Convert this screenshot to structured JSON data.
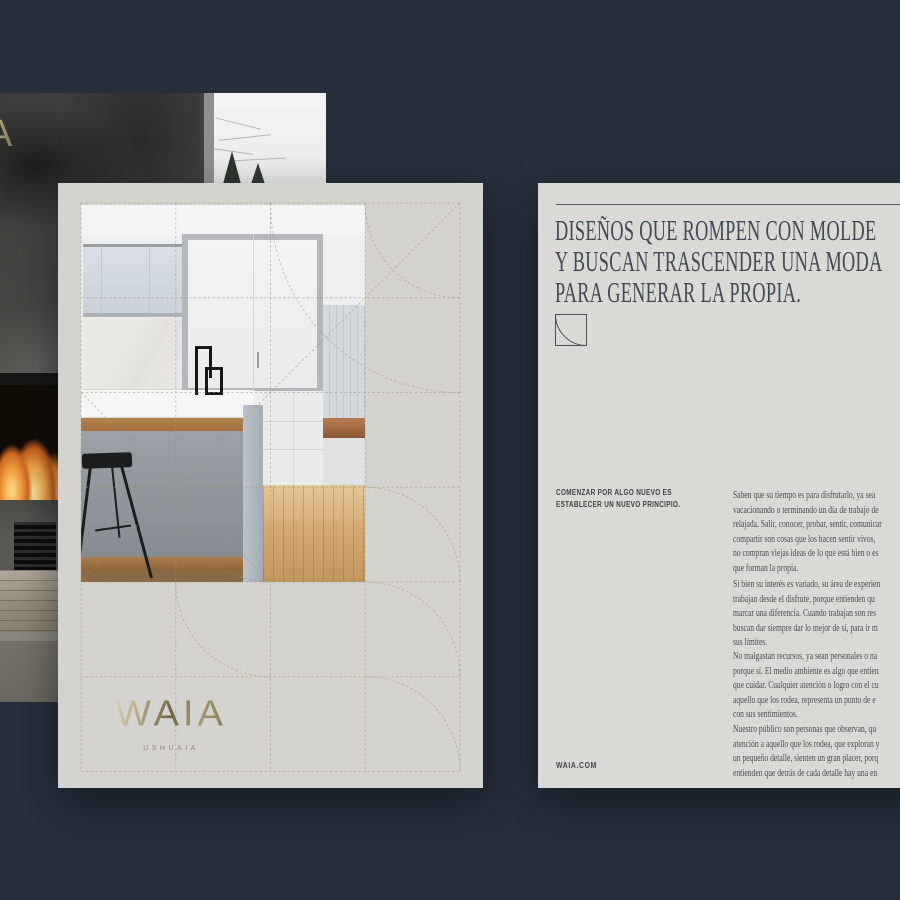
{
  "left_poster": {
    "logo": "WAIA",
    "location": "USHUAIA"
  },
  "right_page": {
    "headline_lines": [
      "DISEÑOS QUE ROMPEN CON MOLDE",
      "Y BUSCAN TRASCENDER UNA MODA",
      "PARA GENERAR LA PROPIA."
    ],
    "eyebrow_lines": [
      "COMENZAR POR ALGO NUEVO ES",
      "ESTABLECER UN NUEVO PRINCIPIO."
    ],
    "paragraphs": [
      {
        "lines": [
          "Saben que su tiempo es para disfrutarlo, ya sea",
          "vacacionando o terminando un día de trabajo de",
          "relajada. Salir, conocer, probar, sentir, comunicar",
          "compartir son cosas que los hacen sentir vivos,",
          "no compran viejas ideas de lo que está bien o es",
          "que forman la propia."
        ]
      },
      {
        "lines": [
          "Si bien su interés es variado, su área de experien",
          "trabajan desde el disfrute, porque entienden qu",
          "marcar una diferencia. Cuando trabajan son res",
          "buscan dar siempre dar lo mejor de sí, para ir m",
          "sus límites."
        ]
      },
      {
        "lines": [
          "No malgastan recursos, ya sean personales o na",
          "porque sí. El medio ambiente es algo que entien",
          "que cuidar. Cualquier atención o logro con el cu",
          "aquello que los rodea, representa un punto de e",
          "con sus sentimientos."
        ]
      },
      {
        "lines": [
          "Nuestro público son personas que observan, qu",
          "atención a aquello que los rodea, que exploran y",
          "un pequeño detalle, sienten un gran placer, porq",
          "entienden que detrás de cada detalle hay una en"
        ]
      }
    ],
    "website": "WAIA.COM"
  },
  "backdrop": {
    "partial_logo_letter": "A"
  },
  "colors": {
    "canvas": "#262f3b",
    "poster_bg": "#d5d3cf",
    "page_bg": "#dbd9d5",
    "gold_line": "#a2956d",
    "headline_text": "#3e4a55",
    "body_text": "#454d55",
    "logo_gold_light": "#d9d2ba",
    "logo_gold_dark": "#6e6548"
  },
  "icons": {
    "arc_square": "quarter-arc inside square"
  }
}
